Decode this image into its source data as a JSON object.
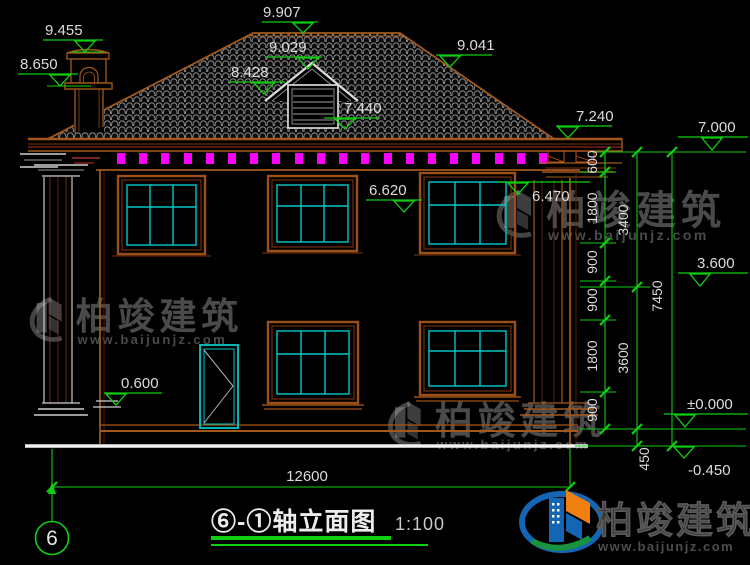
{
  "title_block": {
    "title": "⑥-①轴立面图",
    "scale": "1:100",
    "axis_label": "6"
  },
  "elevations": {
    "chimney_top": "9.455",
    "chimney_cap_base": "8.650",
    "ridge": "9.907",
    "dormer_ridge": "9.029",
    "dormer_eave": "8.428",
    "dormer_louver_base": "7.440",
    "right_roof_point": "9.041",
    "right_eave_top": "7.240",
    "right_eave_level": "7.000",
    "frieze_bottom": "6.620",
    "right_capital_top": "6.470",
    "level_3600": "3.600",
    "porch_level": "0.600",
    "level_zero": "±0.000",
    "outdoor_ground": "-0.450"
  },
  "dimensions": {
    "total_width": "12600",
    "storey_chain": [
      "600",
      "1800",
      "900",
      "900",
      "1800",
      "900"
    ],
    "level_chain": [
      "3400",
      "3600",
      "450"
    ],
    "overall_height": "7450"
  },
  "branding": {
    "company": "柏竣建筑",
    "website": "www.baijunjz.com"
  },
  "colors": {
    "dimension_green": "#10cf10",
    "dentil_magenta": "#ff00ff",
    "window_cyan": "#00c8c8",
    "frame_brown": "#9c4f16",
    "tile_gray": "#9b9b9b"
  }
}
